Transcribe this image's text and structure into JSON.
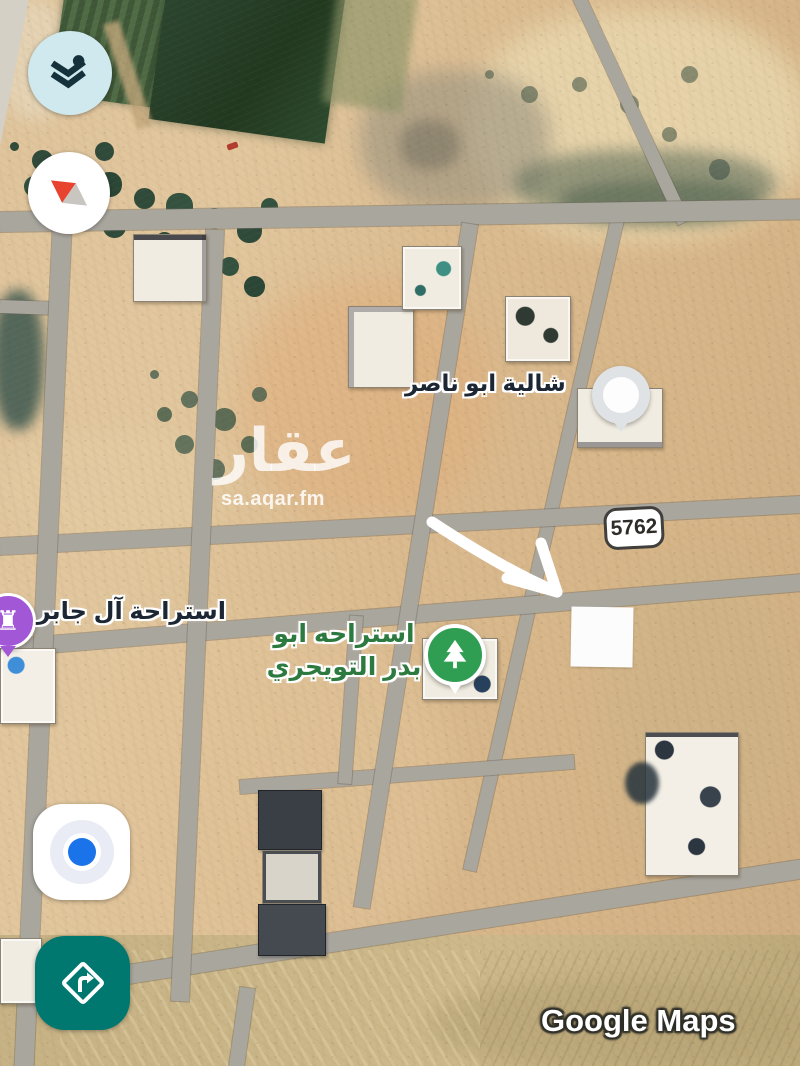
{
  "map": {
    "places": [
      {
        "name": "chalet-abu-nasser",
        "text": "شالية ابو ناصر",
        "pin": "white-circle-pin"
      },
      {
        "name": "istiraha-al-jaber",
        "text": "استراحة آل جابر",
        "pin": "purple-rook-pin"
      },
      {
        "name": "istiraha-abu-badr-altuwaijri",
        "text_line1": "استراحه ابو",
        "text_line2": "بدر التويجري",
        "pin": "green-tree-pin"
      }
    ],
    "route_badge": "5762"
  },
  "watermark": {
    "brand_ar": "عقار",
    "domain": "sa.aqar.fm"
  },
  "attribution": "Google Maps",
  "controls": [
    {
      "name": "layers-button",
      "icon": "layers-icon"
    },
    {
      "name": "compass-button",
      "icon": "compass-needle-icon"
    },
    {
      "name": "my-location-button",
      "icon": "blue-location-dot-icon"
    },
    {
      "name": "directions-button",
      "icon": "turn-right-diamond-icon"
    }
  ],
  "colors": {
    "sand": "#dcc096",
    "road": "#a9a69e",
    "teal_button": "#00786f",
    "layers_button_bg": "#cfe9ee",
    "location_blue": "#1a73e8",
    "pin_purple": "#a257d6",
    "pin_green": "#2f9e53",
    "label_green": "#2c7a3f",
    "label_dark": "#1d2733",
    "compass_red": "#e8432f"
  }
}
